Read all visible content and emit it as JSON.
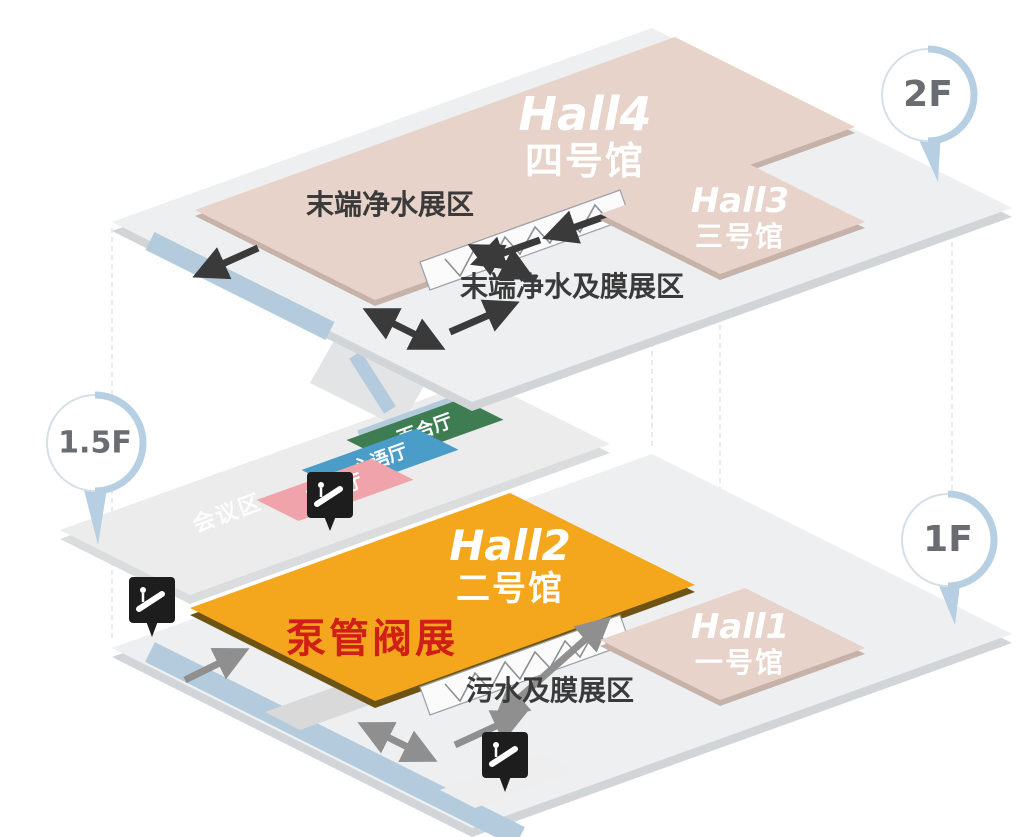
{
  "title": "exhibition-hall-floor-map",
  "floors": {
    "f2": {
      "pin_label": "2F",
      "hall4": {
        "en": "Hall4",
        "cn": "四号馆"
      },
      "hall3": {
        "en": "Hall3",
        "cn": "三号馆"
      },
      "zone_left": "末端净水展区",
      "zone_right": "末端净水及膜展区"
    },
    "f15": {
      "pin_label": "1.5F",
      "meeting_area": "会议区",
      "rooms": {
        "lily": "百合厅",
        "heart": "心语厅",
        "rose": "蔷薇厅"
      }
    },
    "f1": {
      "pin_label": "1F",
      "hall2": {
        "en": "Hall2",
        "cn": "二号馆",
        "highlight": "泵管阀展"
      },
      "hall1": {
        "en": "Hall1",
        "cn": "一号馆"
      },
      "zone_bottom": "污水及膜展区"
    }
  },
  "colors": {
    "hall_tan": "#e7d3c9",
    "hall_tan_side": "#c6b2a8",
    "hall2_orange": "#f4a61d",
    "hall2_side": "#6e5414",
    "highlight_red": "#cf1f16",
    "platform_top": "#edeff0",
    "platform_side": "#d2d5d7",
    "walkway_blue": "#b3cbdc",
    "room_lily": "#3e7d51",
    "room_heart": "#4a9dc9",
    "room_rose": "#f0a3aa",
    "arrow_dark": "#3a3a3a",
    "arrow_gray": "#8f8f8f",
    "sign_black": "#1d1d1d",
    "pin_blue": "#b7cfe2"
  }
}
